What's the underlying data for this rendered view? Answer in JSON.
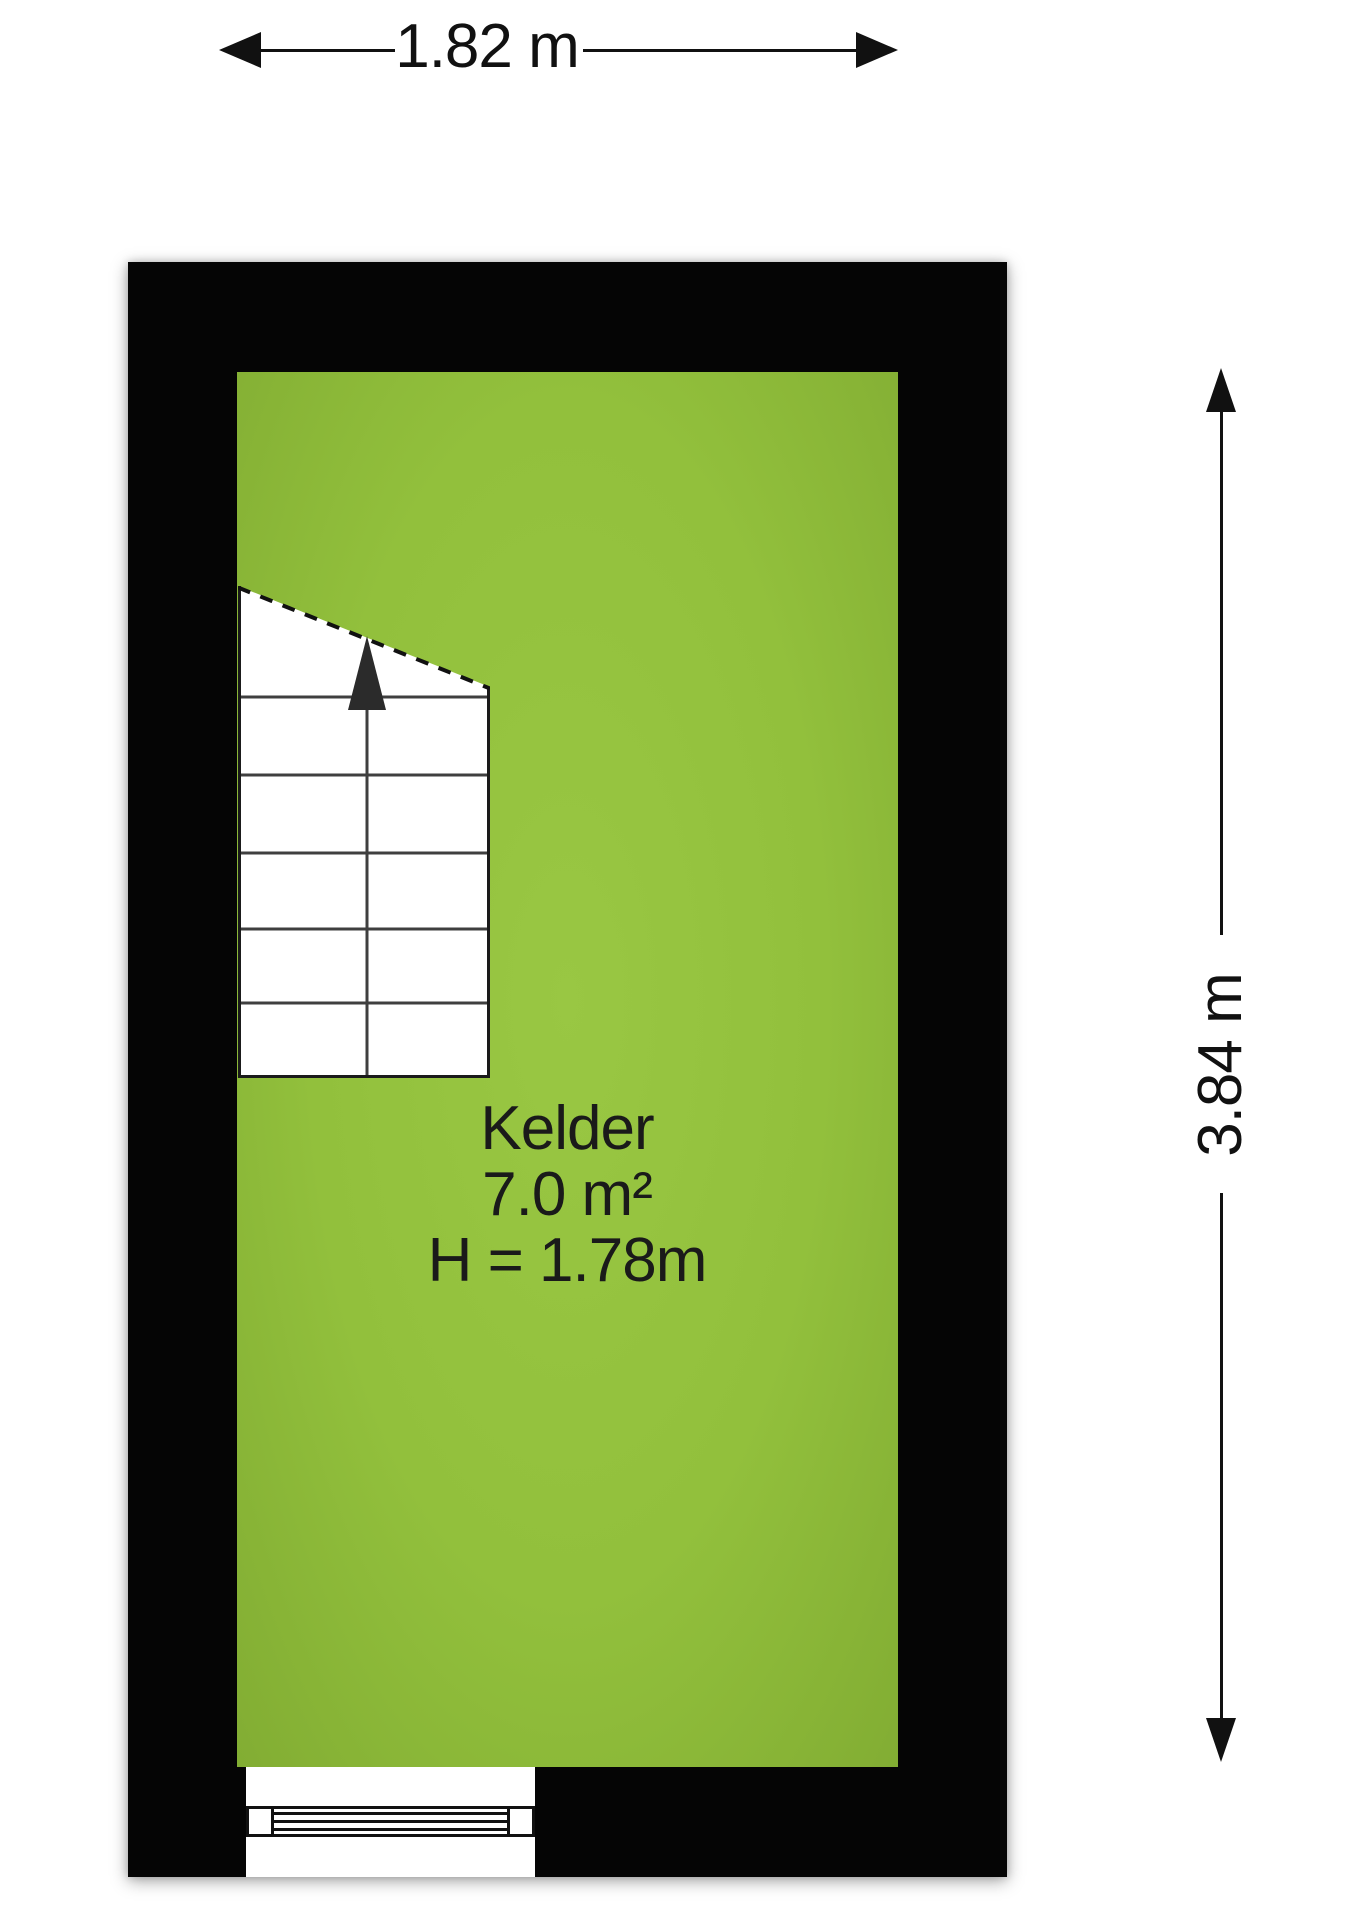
{
  "floorplan": {
    "room": {
      "name": "Kelder",
      "area": "7.0 m²",
      "ceiling_height": "H = 1.78m"
    },
    "dimensions": {
      "width_label": "1.82 m",
      "height_label": "3.84 m"
    },
    "features": {
      "stairs": "staircase with up-direction arrow and dashed headroom line",
      "window": "window in bottom wall"
    },
    "colors": {
      "floor": "#92c03c",
      "wall": "#050505",
      "drawing_line": "#111111",
      "stair_tread_line": "#3f3f3f",
      "background": "#ffffff"
    }
  }
}
